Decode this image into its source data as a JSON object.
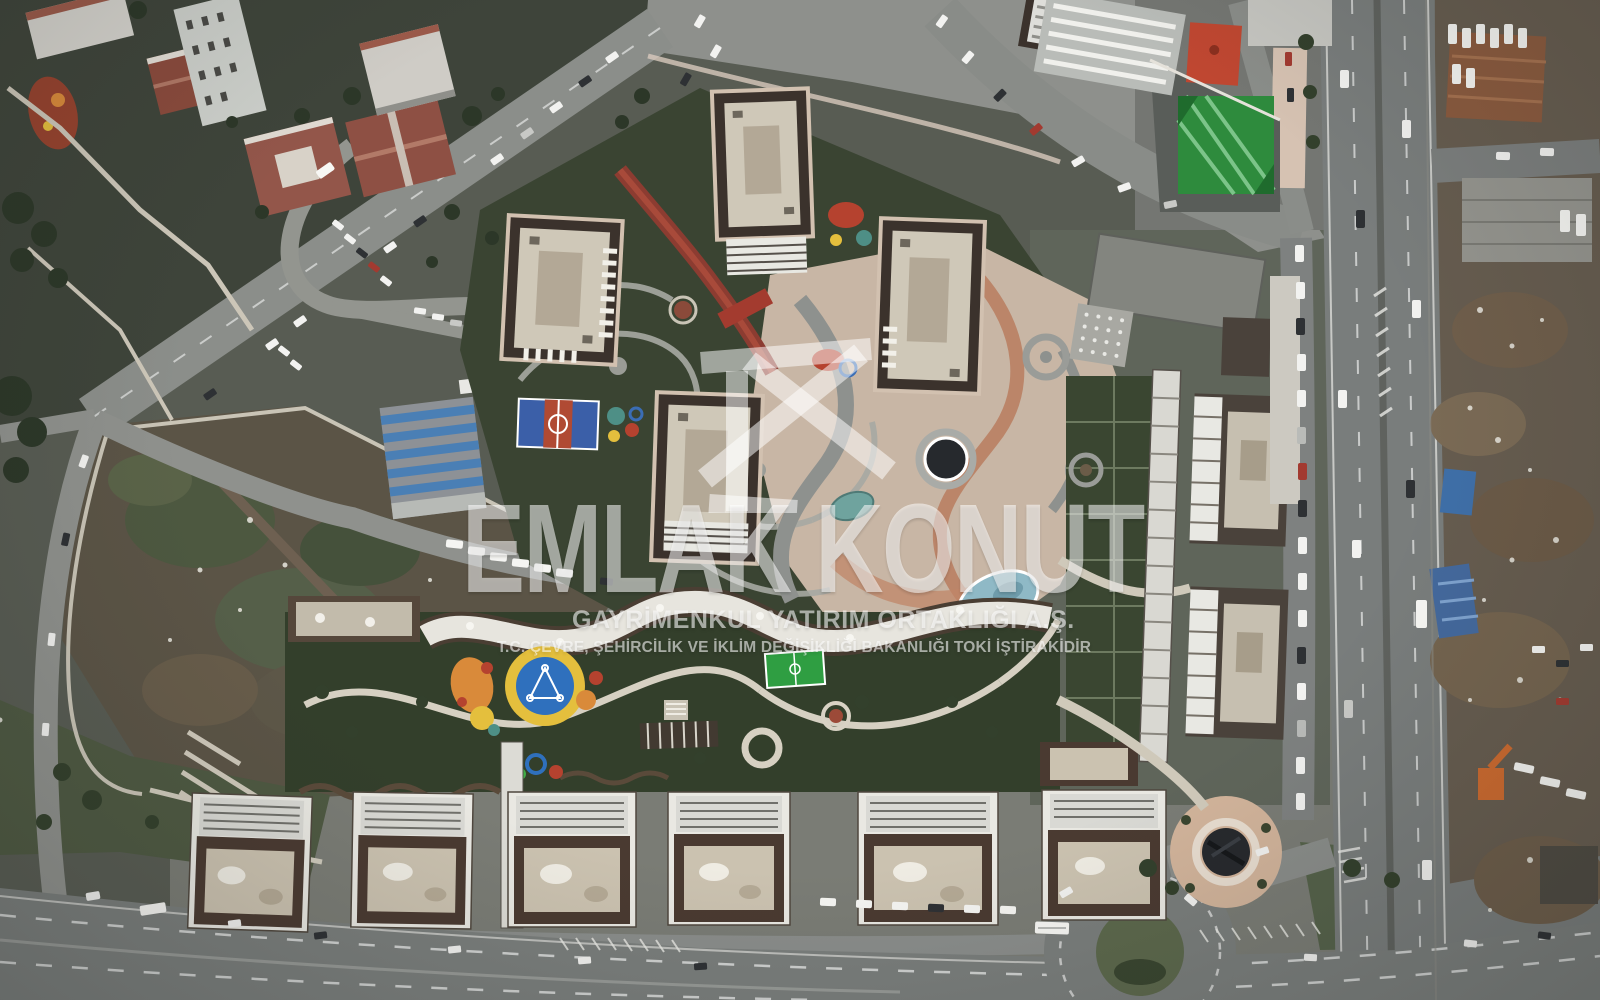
{
  "image": {
    "kind": "aerial drone photograph, top-down",
    "subject": "Emlak Konut mass-housing estate and surroundings",
    "lighting": "overcast daylight",
    "width_px": 1600,
    "height_px": 1000
  },
  "watermark": {
    "logo": "emlak-konut-house-logo",
    "title": "EMLAK KONUT",
    "subtitle": "GAYRİMENKUL YATIRIM ORTAKLIĞI A.Ş.",
    "tagline": "T.C. ÇEVRE, ŞEHİRCİLİK VE İKLİM DEĞİŞİKLİĞİ BAKANLIĞI TOKİ İŞTİRAKİDİR",
    "color": "#ffffff",
    "opacity": 0.58
  },
  "scene": {
    "features": [
      "residential tower blocks with dark parapets and pale rooftops",
      "landscaped plaza with swirling paths, circular pools and teal ponds",
      "red pedestrian bridge and red carpet walkway",
      "basketball court and colorful playgrounds",
      "mini football pitch",
      "linear park strip with wavy paths",
      "row of low-rise blocks with rooftop solar panels",
      "vacant construction lot",
      "older red-roofed neighborhood with parked cars",
      "vertical expressway with median and chevrons",
      "wide curved boulevard along the bottom",
      "roundabout with grass island",
      "industrial and scrap yards on the right",
      "circular plaza with dark round pool"
    ],
    "palette": {
      "ground": "#585c53",
      "asphalt": "#7a7e7c",
      "plaza_tan": "#c8b6a5",
      "roof_dark": "#3b322c",
      "roof_light": "#cfc8b8",
      "courtyard_green": "#3a4432",
      "turf_green": "#2e8b3d",
      "court_blue": "#3b5fa8",
      "court_red": "#b04a33",
      "pool_dark": "#26292d",
      "water_teal": "#6fa39e",
      "water_blue": "#8fb9c6",
      "playground_yellow": "#e4bf3d",
      "playground_orange": "#d98a3a",
      "playground_blue": "#2f70bd",
      "white_block": "#e9e8e2",
      "terracotta_roof": "#8a4a3c"
    }
  }
}
